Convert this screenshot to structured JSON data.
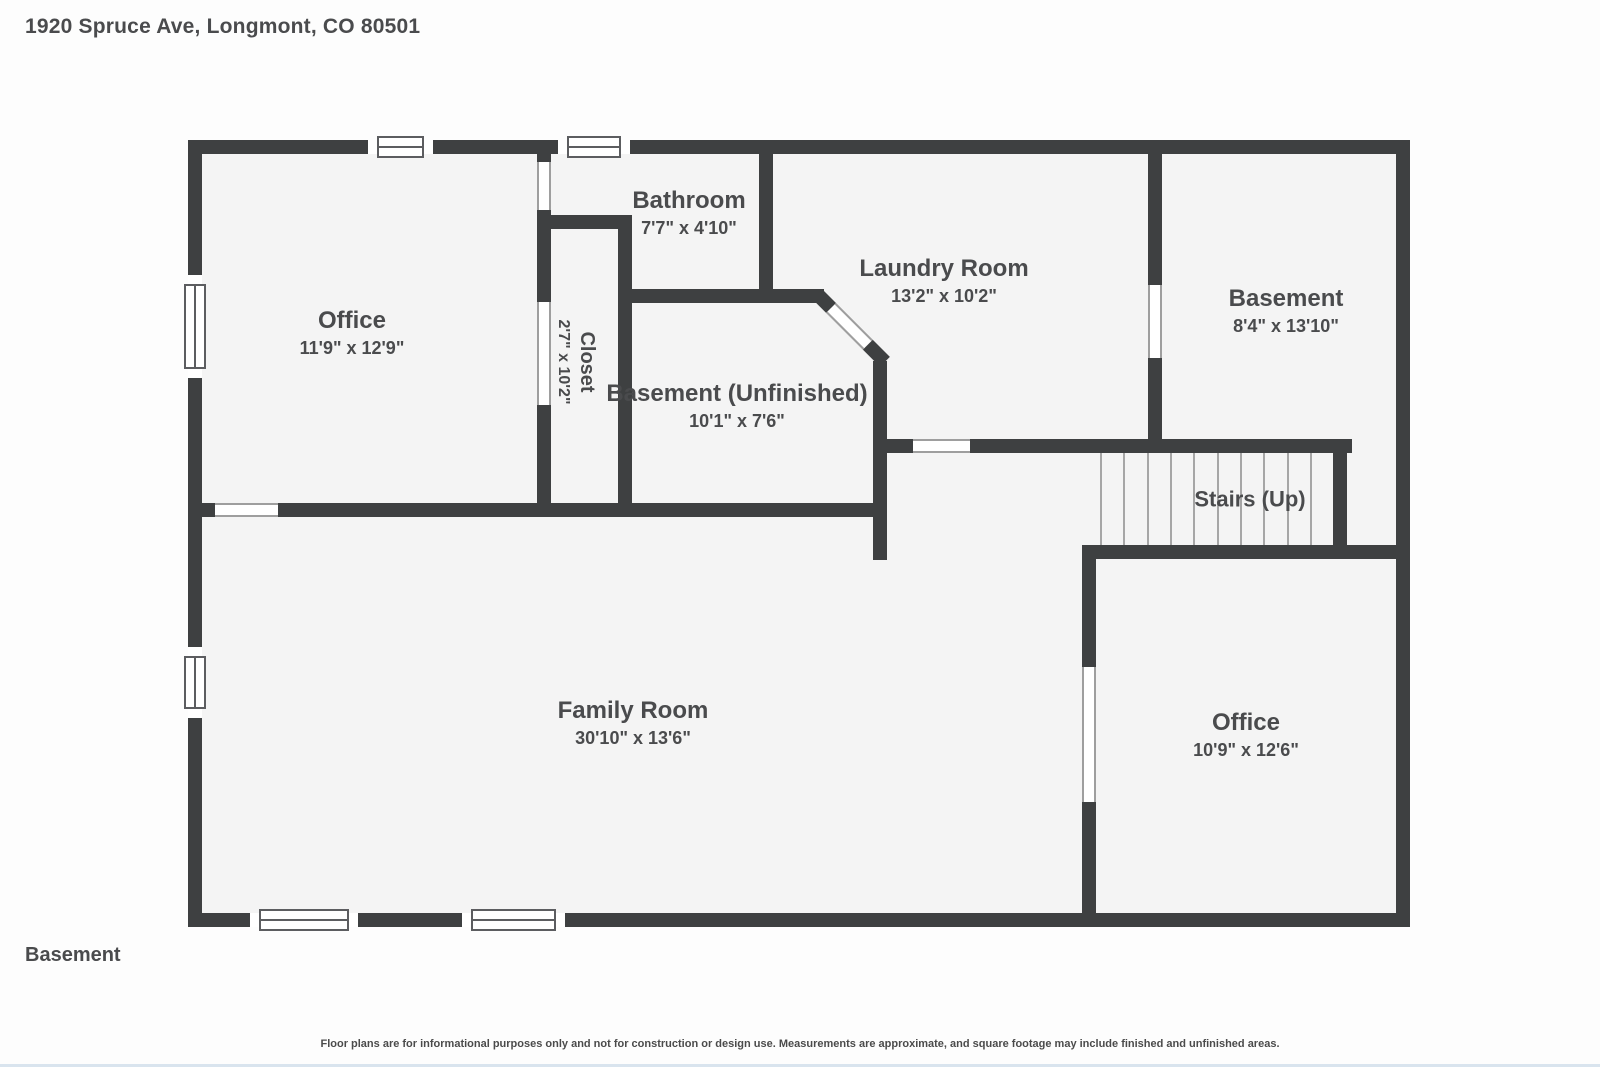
{
  "page": {
    "title": "1920 Spruce Ave, Longmont, CO 80501",
    "floor_label": "Basement",
    "disclaimer": "Floor plans are for informational purposes only and not for construction or design use. Measurements are approximate, and square footage may include finished and unfinished areas."
  },
  "rooms": {
    "office_top_left": {
      "name": "Office",
      "dims": "11'9\" x 12'9\""
    },
    "closet": {
      "name": "Closet",
      "dims": "2'7\" x 10'2\""
    },
    "bathroom": {
      "name": "Bathroom",
      "dims": "7'7\" x 4'10\""
    },
    "laundry": {
      "name": "Laundry Room",
      "dims": "13'2\" x 10'2\""
    },
    "basement_top_right": {
      "name": "Basement",
      "dims": "8'4\" x 13'10\""
    },
    "basement_unfinished": {
      "name": "Basement (Unfinished)",
      "dims": "10'1\" x 7'6\""
    },
    "stairs": {
      "name": "Stairs (Up)"
    },
    "family_room": {
      "name": "Family Room",
      "dims": "30'10\" x 13'6\""
    },
    "office_bottom_right": {
      "name": "Office",
      "dims": "10'9\" x 12'6\""
    }
  },
  "colors": {
    "wall": "#3e4041",
    "floor": "#f4f4f4",
    "text": "#4a4b4d",
    "window_line": "#5c5d60",
    "door_gap_line": "#9e9e9e",
    "stair_tread": "#a6a6a6",
    "bottom_accent": "#d9e4ee",
    "page_background": "#fdfdfd"
  }
}
